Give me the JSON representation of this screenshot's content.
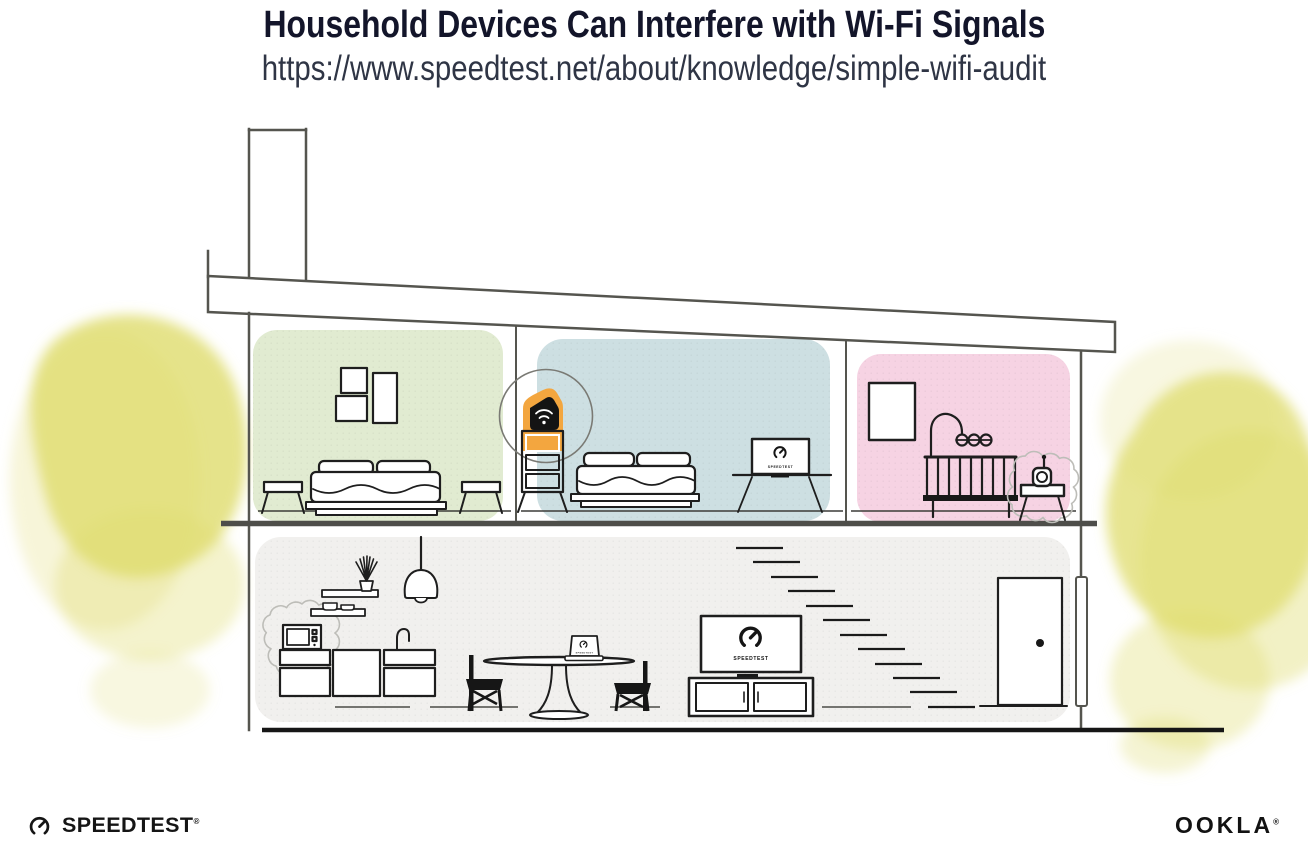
{
  "header": {
    "title": "Household Devices Can Interfere with Wi-Fi Signals",
    "url": "https://www.speedtest.net/about/knowledge/simple-wifi-audit"
  },
  "illustration": {
    "screen_label": "SPEEDTEST",
    "colors": {
      "room_green": "#e1ebd1",
      "room_blue": "#cddfe2",
      "room_pink": "#f6d3e3",
      "ground_gray": "#f1f0ee",
      "bush_yellow": "#dfdc6d",
      "bush_yellow_light": "#e9e69b",
      "router_orange": "#f3a63f",
      "line_dark": "#1c1c1c",
      "structure_gray": "#55554f",
      "interference_gray": "#bdbdb8",
      "title_navy": "#13152a"
    },
    "objects": [
      "chimney",
      "slanted-roof",
      "wifi-router-on-shelf",
      "router-highlight-circle",
      "green-bedroom-bed",
      "picture-frames",
      "blue-bedroom-bed",
      "monitor-showing-speedtest",
      "pink-nursery-crib",
      "crib-mobile",
      "baby-monitor-with-interference",
      "wall-art-frame",
      "kitchen-shelves",
      "pendant-lamp",
      "microwave-with-interference",
      "kitchen-cabinets",
      "faucet",
      "dining-table",
      "laptop-showing-speedtest",
      "dining-chairs",
      "tv-showing-speedtest",
      "media-console",
      "floating-stairs",
      "front-door",
      "downspout",
      "yellow-bushes"
    ]
  },
  "footer": {
    "speedtest_label": "SPEEDTEST",
    "speedtest_reg": "®",
    "ookla_label": "OOKLA",
    "ookla_reg": "®"
  }
}
